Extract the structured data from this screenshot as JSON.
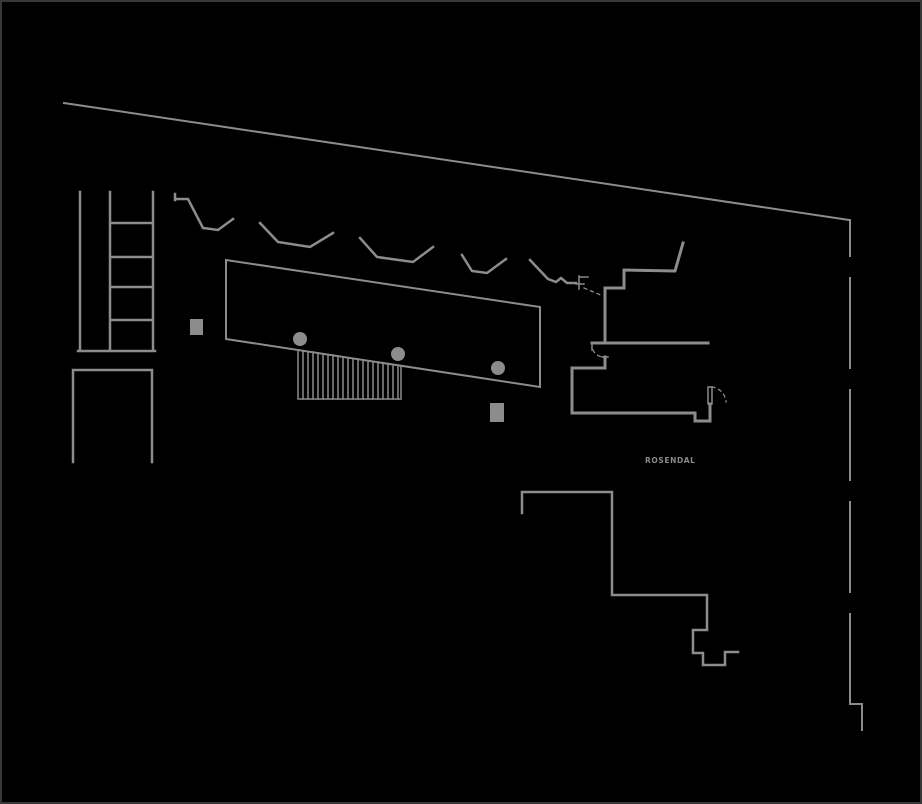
{
  "canvas": {
    "background": "#000000",
    "border_color": "#383838",
    "line_color": "#8c8c8c",
    "label_color": "#8a8a8a"
  },
  "site": {
    "label": {
      "text": "ROSENDAL"
    }
  }
}
